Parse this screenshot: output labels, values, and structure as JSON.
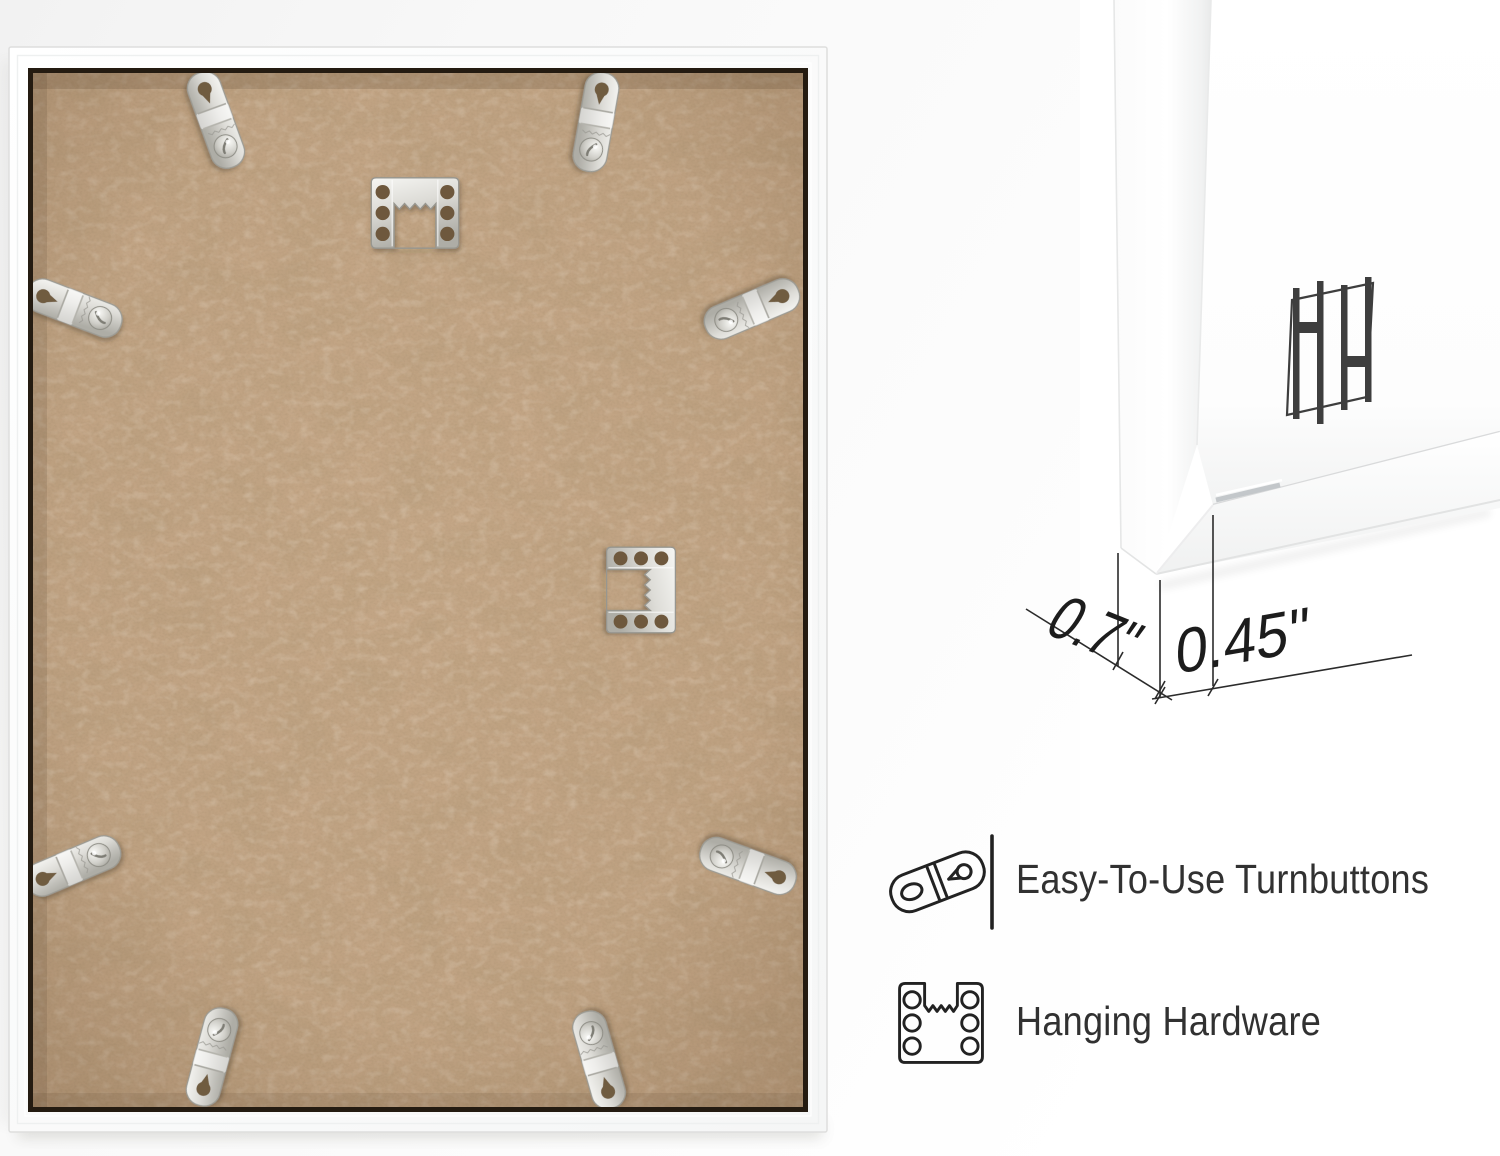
{
  "closeup": {
    "depth_label": "0.7\"",
    "face_width_label": "0.45\"",
    "logo_icon": "hh-monogram"
  },
  "features": [
    {
      "icon": "turnbutton-icon",
      "label": "Easy-To-Use Turnbuttons"
    },
    {
      "icon": "sawtooth-hanger-icon",
      "label": "Hanging Hardware"
    }
  ],
  "colors": {
    "mdf_board": "#c5a787",
    "frame_white": "#fbfcfc",
    "metal": "#d8d7d2",
    "ink": "#2e2e2e"
  }
}
